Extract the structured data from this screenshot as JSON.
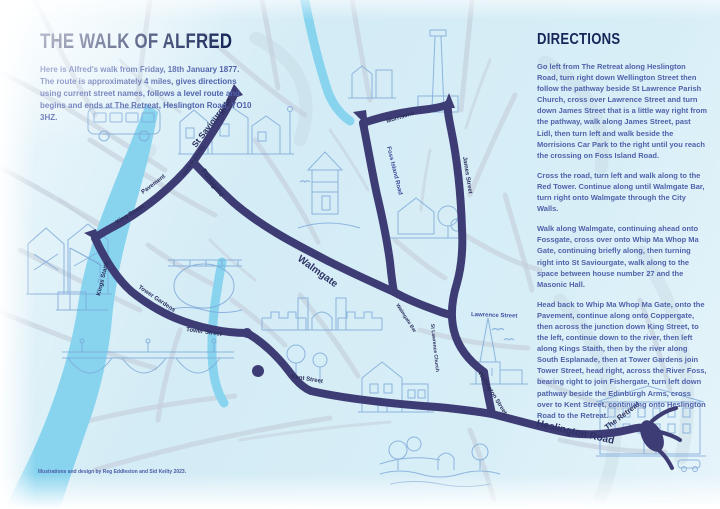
{
  "page": {
    "title": "THE WALK OF ALFRED",
    "intro": "Here is Alfred's walk from Friday, 18th January 1877. The route is approximately 4 miles, gives directions using current street names, follows a level route and begins and ends at The Retreat, Heslington Road, YO10 3HZ.",
    "credit": "Illustrations and design by Reg Eddleston and Sid Keilty 2023."
  },
  "directions": {
    "heading": "DIRECTIONS",
    "paragraphs": [
      "Go left from The Retreat along Heslington Road, turn right down Wellington Street then follow the pathway beside St Lawrence Parish Church, cross over Lawrence Street and turn down James Street that is a little way right from the pathway, walk along James Street, past Lidl, then turn left and walk beside the Morrisions Car Park to the right until you reach the crossing on Foss Island Road.",
      "Cross the road, turn left and walk along to the Red Tower.  Continue along until Walmgate Bar, turn right onto Walmgate through the City Walls.",
      "Walk along Walmgate, continuing ahead onto Fossgate, cross over onto Whip Ma Whop Ma Gate, continuing briefly along, then turning right into St Saviourgate, walk along to the space between house number 27 and the Masonic Hall.",
      "Head back to Whip Ma Whop Ma Gate, onto the Pavement, continue along onto Coppergate, then across the junction down King Street, to the left, continue down to the river, then left along Kings Staith, then by the river along South Esplanade, then at Tower Gardens join Tower Street, head right, across the River Foss, bearing right to join Fishergate, turn left down pathway beside the Edinburgh Arms, cross over to Kent Street, continuing onto Heslington Road to the Retreat."
    ]
  },
  "map": {
    "route_color": "#3e3c74",
    "river_color": "#88d4ef",
    "road_color": "#c5d0db",
    "sketch_color": "#7aa6d8",
    "labels": [
      {
        "text": "St Saviourgate"
      },
      {
        "text": "Pavement"
      },
      {
        "text": "Fossgate"
      },
      {
        "text": "King Street"
      },
      {
        "text": "Kings Staith"
      },
      {
        "text": "Tower Gardens"
      },
      {
        "text": "Tower Street"
      },
      {
        "text": "Kent Street"
      },
      {
        "text": "Walmgate"
      },
      {
        "text": "Walmgate Bar"
      },
      {
        "text": "St Lawrence Church"
      },
      {
        "text": "Lawrence Street"
      },
      {
        "text": "Wellington Street"
      },
      {
        "text": "Heslington Road"
      },
      {
        "text": "The Retreat"
      },
      {
        "text": "Morrisons"
      },
      {
        "text": "Foss Island Road"
      },
      {
        "text": "James Street"
      },
      {
        "text": "Whip Ma Whop Ma Gate"
      }
    ],
    "illustrations": [
      "horse-coach",
      "street-buildings",
      "factory-chimney",
      "city-buildings",
      "red-tower",
      "house-with-trees",
      "timber-framed-houses",
      "riverside-crane",
      "ouse-bridge",
      "skeldergate-bridge",
      "walmgate-bar",
      "edinburgh-arms",
      "st-lawrence-church",
      "the-retreat-building",
      "foss-pond-scene",
      "trees",
      "birds"
    ]
  }
}
